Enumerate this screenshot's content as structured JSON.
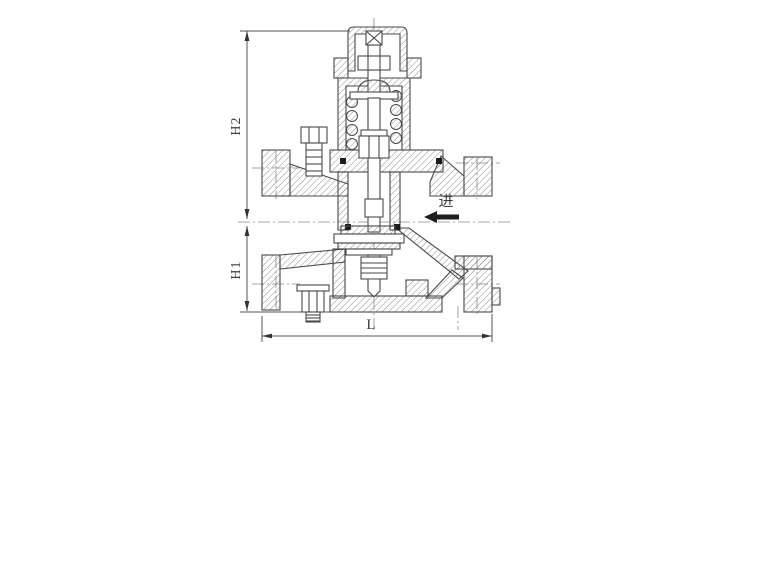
{
  "drawing": {
    "description": "sectional engineering drawing of a spring-loaded pressure reducing valve",
    "dimension_labels": {
      "h2": "H2",
      "h1": "H1",
      "l": "L"
    },
    "flow": {
      "inlet_label": "进",
      "arrow_direction": "left"
    }
  },
  "colors": {
    "background": "#ffffff",
    "line": "#494949",
    "hatch": "#6b6b6b",
    "dimension": "#555555",
    "arrow_fill": "#1f1f1f"
  }
}
